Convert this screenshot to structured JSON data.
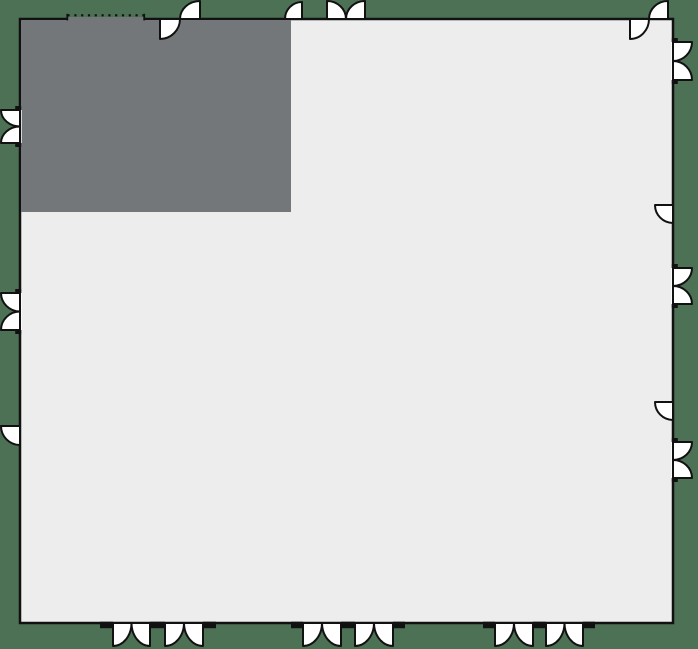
{
  "scene": {
    "width": 698,
    "height": 649,
    "colors": {
      "background": "#4c7154",
      "floor": "#ededee",
      "dark_room": "#737779",
      "line": "#111111",
      "door_fill": "#ffffff",
      "dash": "#b5b5b5"
    }
  },
  "floorplan": {
    "outer_wall": {
      "left": 20,
      "top": 19,
      "right": 673,
      "bottom": 623,
      "stroke_width": 2.5
    },
    "dark_room": {
      "left": 20,
      "top": 19,
      "right": 291,
      "bottom": 212
    },
    "dotted_opening": {
      "edge": "top",
      "a": 66.5,
      "b": 145,
      "y": 15.3
    },
    "doors": [
      {
        "edge": "top",
        "kind": "pair_s",
        "a": 160,
        "b": 200
      },
      {
        "edge": "top",
        "kind": "single",
        "a": 285,
        "b": 302,
        "hinge": "b",
        "side": "out"
      },
      {
        "edge": "top",
        "kind": "double",
        "a": 327,
        "b": 365,
        "side": "out",
        "leaf": 18
      },
      {
        "edge": "top",
        "kind": "pair_s",
        "a": 630,
        "b": 668
      },
      {
        "edge": "right",
        "kind": "butterfly",
        "a": 42,
        "b": 80,
        "leaf": 19
      },
      {
        "edge": "right",
        "kind": "single",
        "a": 205,
        "b": 223,
        "hinge": "a",
        "side": "in"
      },
      {
        "edge": "right",
        "kind": "butterfly",
        "a": 268,
        "b": 304,
        "leaf": 19
      },
      {
        "edge": "right",
        "kind": "single",
        "a": 402,
        "b": 420,
        "hinge": "a",
        "side": "in"
      },
      {
        "edge": "right",
        "kind": "butterfly",
        "a": 442,
        "b": 478,
        "leaf": 19
      },
      {
        "edge": "bottom",
        "kind": "double",
        "a": 113,
        "b": 150,
        "side": "out",
        "leaf": 23
      },
      {
        "edge": "bottom",
        "kind": "double",
        "a": 165,
        "b": 203,
        "side": "out",
        "leaf": 23
      },
      {
        "edge": "bottom",
        "kind": "double",
        "a": 303,
        "b": 341,
        "side": "out",
        "leaf": 23
      },
      {
        "edge": "bottom",
        "kind": "double",
        "a": 355,
        "b": 393,
        "side": "out",
        "leaf": 23
      },
      {
        "edge": "bottom",
        "kind": "double",
        "a": 495,
        "b": 533,
        "side": "out",
        "leaf": 23
      },
      {
        "edge": "bottom",
        "kind": "double",
        "a": 546,
        "b": 583,
        "side": "out",
        "leaf": 23
      },
      {
        "edge": "left",
        "kind": "butterfly",
        "a": 110,
        "b": 143,
        "leaf": 19
      },
      {
        "edge": "left",
        "kind": "butterfly",
        "a": 293,
        "b": 330,
        "leaf": 19
      },
      {
        "edge": "left",
        "kind": "single",
        "a": 426,
        "b": 445,
        "hinge": "a",
        "side": "out"
      }
    ],
    "bottom_jamb_stubs": [
      [
        100,
        113
      ],
      [
        150,
        165
      ],
      [
        203,
        216
      ],
      [
        291,
        303
      ],
      [
        341,
        355
      ],
      [
        393,
        405
      ],
      [
        483,
        495
      ],
      [
        533,
        546
      ],
      [
        583,
        595
      ]
    ],
    "stub_depth": 6.5,
    "butterfly_tab": {
      "width": 4,
      "depth": 6
    }
  }
}
